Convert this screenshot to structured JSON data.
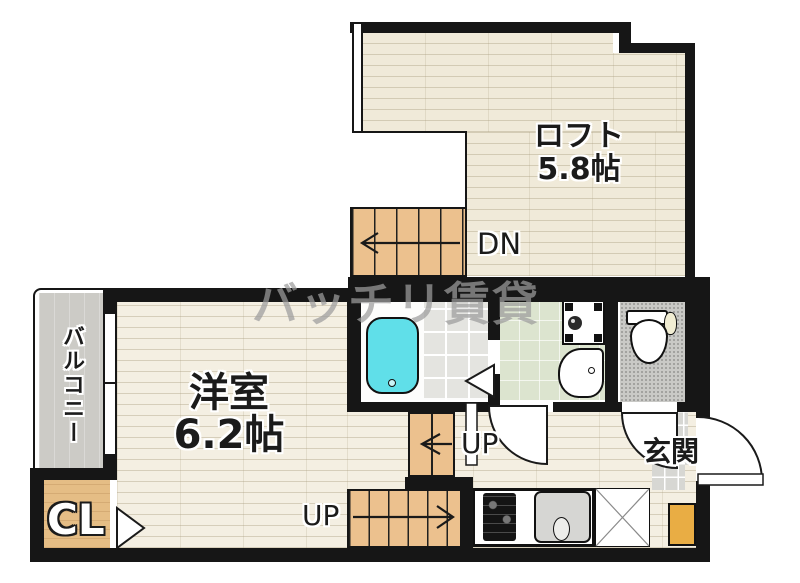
{
  "watermark": "バッチリ賃貸",
  "rooms": {
    "loft": {
      "name": "ロフト",
      "size": "5.8帖"
    },
    "western_room": {
      "name": "洋室",
      "size": "6.2帖"
    },
    "balcony": {
      "name": "バルコニー"
    },
    "closet": {
      "name": "CL"
    },
    "entrance": {
      "name": "玄関"
    }
  },
  "stairs": {
    "down_label": "DN",
    "up_label_mid": "UP",
    "up_label_lower": "UP"
  },
  "colors": {
    "wall": "#161616",
    "loft_floor": "#f0ead9",
    "room_floor": "#f4efe2",
    "stair": "#ecc18e",
    "balcony": "#cccbc6",
    "closet_floor": "#e5bd85",
    "washroom_floor": "#dce4cf",
    "toilet_floor": "#c9c9c6",
    "bath_tile": "#e4e4e0",
    "entrance_tile": "#d7d7d3",
    "bathtub": "#60dfe9",
    "cabinet": "#e9ad44"
  }
}
